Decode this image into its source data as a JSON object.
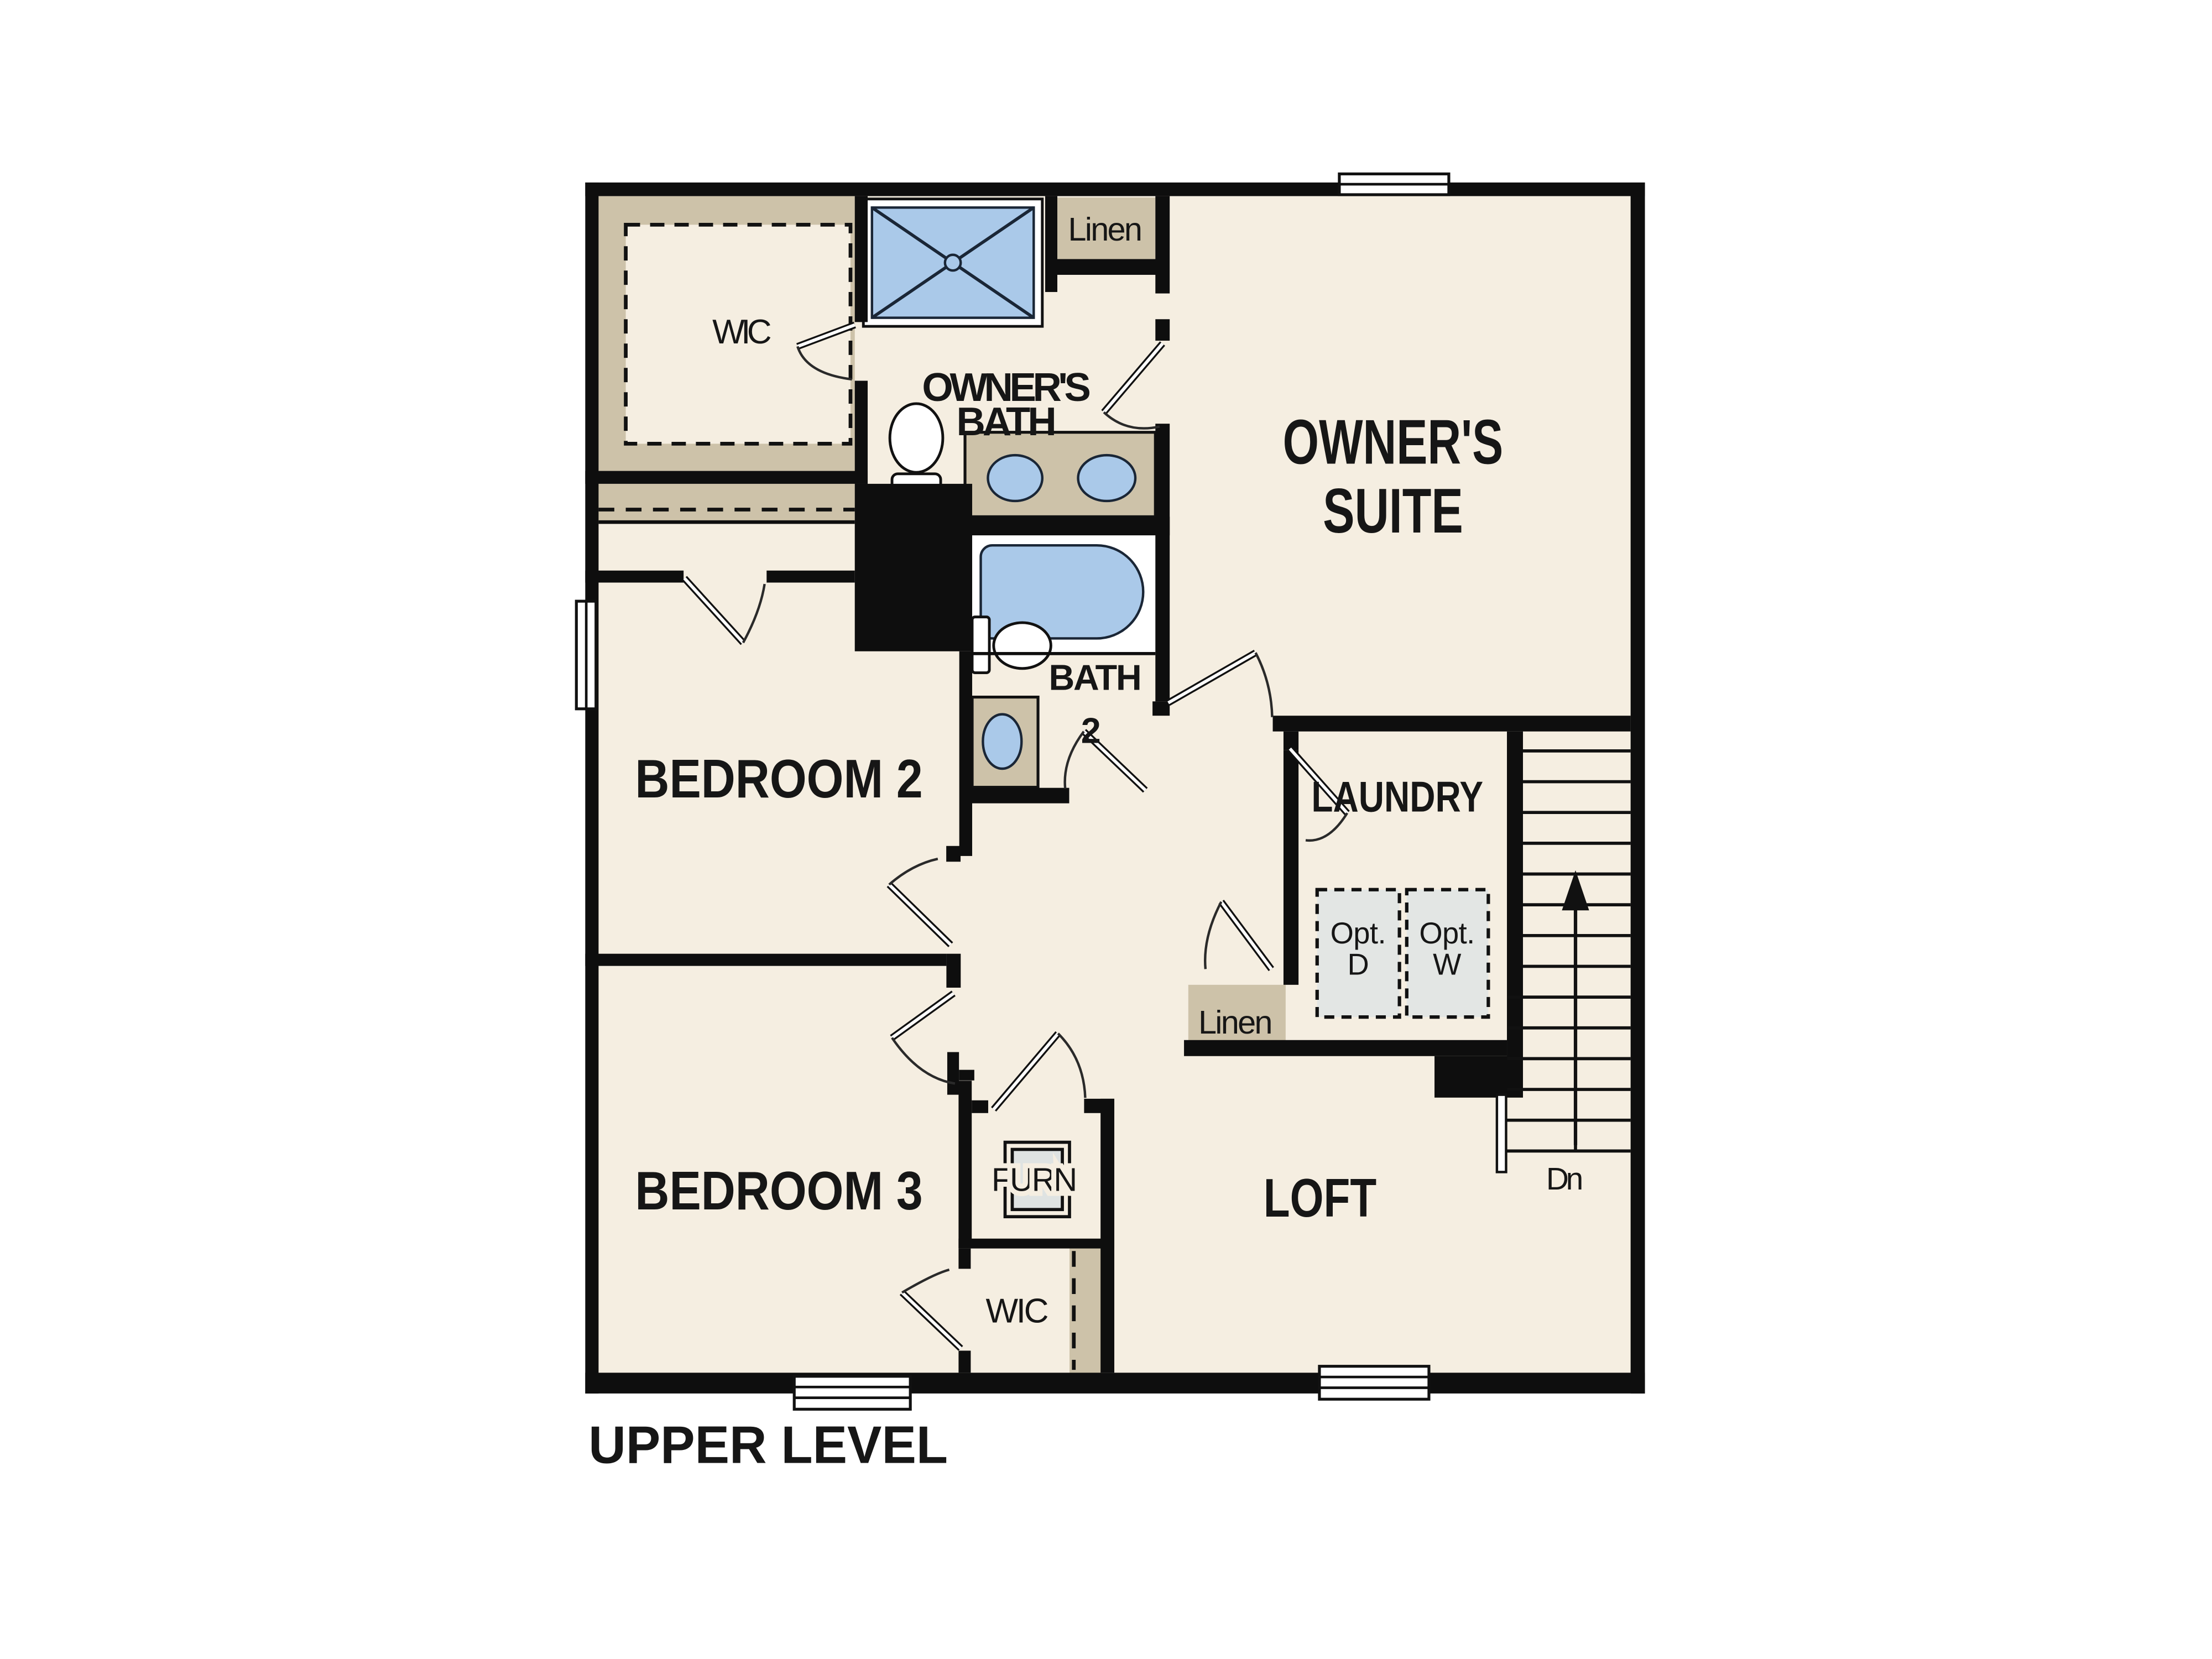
{
  "colors": {
    "floor": "#f5eee1",
    "tan": "#cdc2a9",
    "wall": "#0e0e0e",
    "fixture_blue": "#aac9e9",
    "option_gray": "#e3e6e4"
  },
  "labels": {
    "wic_upper": "WIC",
    "owners_bath": [
      "OWNER'S",
      "BATH"
    ],
    "linen_upper": "Linen",
    "owners_suite": [
      "OWNER'S",
      "SUITE"
    ],
    "bedroom_2": "BEDROOM 2",
    "bath_2": [
      "BATH",
      "2"
    ],
    "laundry": "LAUNDRY",
    "opt_dryer": [
      "Opt.",
      "D"
    ],
    "opt_washer": [
      "Opt.",
      "W"
    ],
    "linen_mid": "Linen",
    "bedroom_3": "BEDROOM 3",
    "furnace": "FURN",
    "wic_lower": "WIC",
    "loft": "LOFT",
    "stairs_down": "Dn",
    "plan_title": "UPPER LEVEL"
  }
}
